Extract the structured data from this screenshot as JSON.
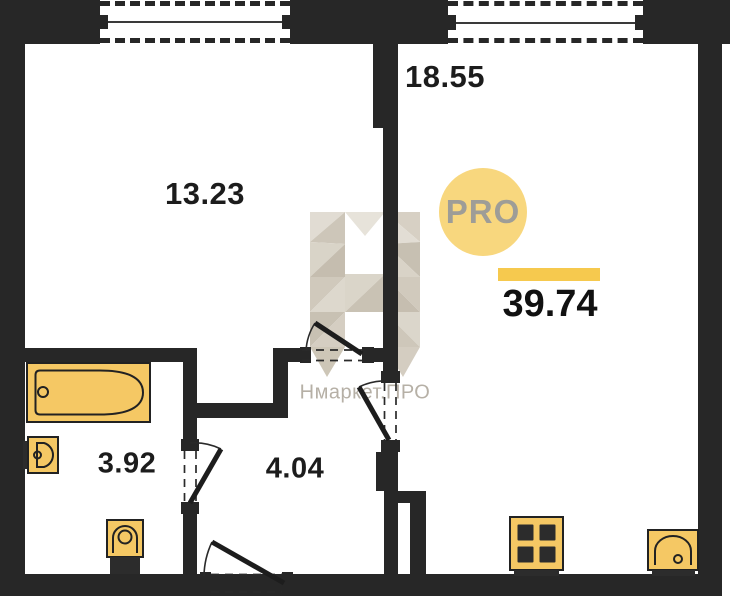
{
  "floorplan": {
    "rooms": [
      {
        "name": "room-top-left",
        "area_label": "13.23"
      },
      {
        "name": "room-top-right",
        "area_label": "18.55"
      },
      {
        "name": "bathroom",
        "area_label": "3.92"
      },
      {
        "name": "hallway",
        "area_label": "4.04"
      }
    ],
    "total_area_label": "39.74"
  },
  "branding": {
    "logo_badge_text": "PRO",
    "watermark_text": "Нмаркет.ПРО"
  },
  "colors": {
    "wall": "#272727",
    "fixture": "#F5C864",
    "badge": "#F8D77E",
    "bar": "#F6C94E",
    "wm-text": "#B6B0A6"
  }
}
